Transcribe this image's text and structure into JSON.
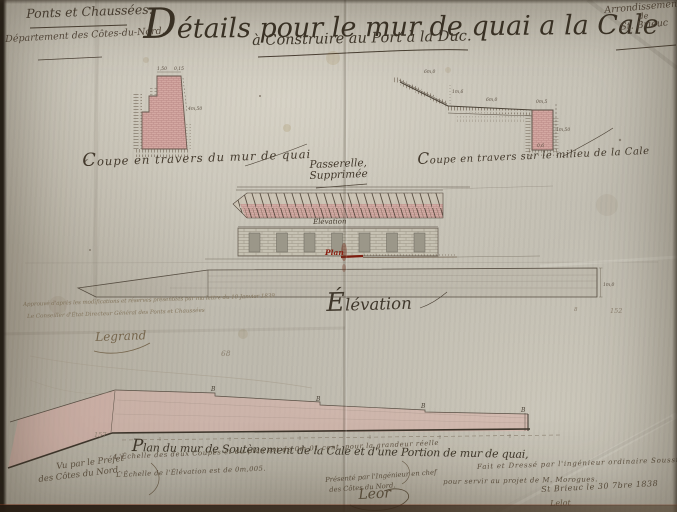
{
  "colors": {
    "paper": "#bfbbaf",
    "ink": "#43392c",
    "faded_ink": "#85775f",
    "red_ink": "#8a1e10",
    "pink_wash": "#d9b0a8",
    "masonry_pink": "#d4a8a2"
  },
  "header": {
    "org": "Ponts et Chaussées.",
    "department": "Département des Côtes-du-Nord.",
    "title": "Détails pour le mur de quai a la Cale",
    "subtitle": "à Construire au Port à la Duc.",
    "arrondissement_line1": "Arrondissement",
    "arrondissement_line2": "de",
    "arrondissement_line3": "St. Brieuc"
  },
  "captions": {
    "coupe_left": "Coupe en travers du mur de quai",
    "coupe_right": "Coupe en travers sur le milieu de la Cale",
    "passerelle_line1": "Passerelle,",
    "passerelle_line2": "Supprimée",
    "elevation_small": "Elévation",
    "plan_red": "Plan",
    "elevation_big": "Élévation",
    "plan_label": "Plan du mur de Soutènement de la Cale et d'une Portion de mur de quai,"
  },
  "dimensions": {
    "left_coupe": {
      "top1": "1,50",
      "top2": "0,15",
      "right": "4m,50"
    },
    "right_coupe": {
      "slope": "6m,0",
      "vert": "1m,6",
      "horiz": "6m,0",
      "top": "0m,5",
      "side": "1m,50",
      "bottom": "0,6"
    },
    "elevation_right": "1m,0",
    "plan_marks": [
      "B",
      "B",
      "B",
      "B"
    ]
  },
  "annotations": {
    "approval_line1": "Approuvé d'après les modifications et réserves présentées par ma lettre du 10 Janvier 1839",
    "approval_line2": "Le Conseiller d'État Directeur Général des Ponts et Chaussées",
    "approval_signature": "Legrand",
    "pencil_68": "68",
    "pencil_8": "8",
    "pencil_152": "152",
    "pencil_157": "157"
  },
  "footer": {
    "vu_line1": "Vu par le Préfet",
    "vu_line2": "des Côtes du Nord.",
    "scale_line1": "L'Échelle des deux Coupes et du plan est de 0m,01 cent. pour la grandeur réelle",
    "scale_line2": "L'Échelle de l'Élévation est de 0m,005.",
    "presented_line1": "Présenté par l'Ingénieur en chef",
    "presented_line2": "des Côtes du Nord.",
    "presented_signature": "Leor",
    "made_line1": "Fait et Dressé par l'ingénieur ordinaire Soussigné",
    "made_line2": "pour servir au projet de M. Morogues.",
    "made_line3": "St Brieuc le 30 7bre 1838",
    "made_signature": "Lelot"
  }
}
